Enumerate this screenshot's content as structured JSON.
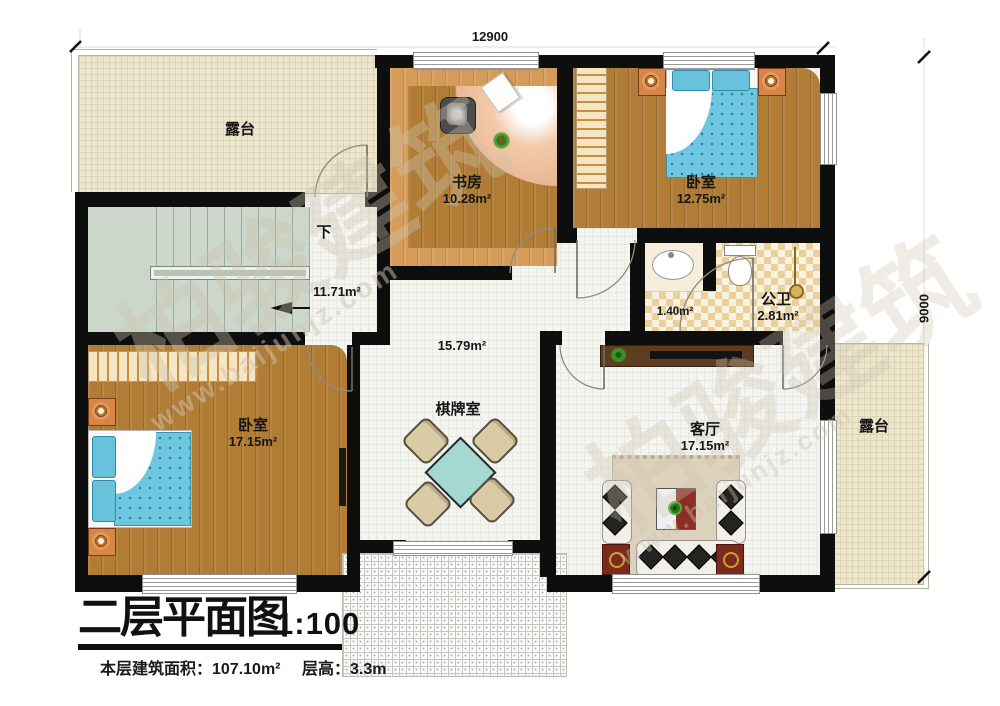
{
  "dimensions": {
    "top": "12900",
    "right": "9000"
  },
  "rooms": {
    "terrace_top": {
      "label": "露台"
    },
    "terrace_right": {
      "label": "露台"
    },
    "study": {
      "name": "书房",
      "area": "10.28m²"
    },
    "bedroom_top": {
      "name": "卧室",
      "area": "12.75m²"
    },
    "bathroom": {
      "name": "公卫",
      "area": "2.81m²"
    },
    "vestibule": {
      "area": "1.40m²"
    },
    "hall": {
      "area": "15.79m²"
    },
    "stairs": {
      "direction": "下",
      "area": "11.71m²"
    },
    "bedroom_left": {
      "name": "卧室",
      "area": "17.15m²"
    },
    "chess_room": {
      "name": "棋牌室"
    },
    "living_room": {
      "name": "客厅",
      "area": "17.15m²"
    }
  },
  "title_block": {
    "title": "二层平面图",
    "scale": "1:100",
    "floor_area": "本层建筑面积：107.10m²",
    "floor_height": "层高：3.3m"
  },
  "watermark": {
    "cn": "柏骏建筑",
    "url": "www.baijunjz.com"
  }
}
